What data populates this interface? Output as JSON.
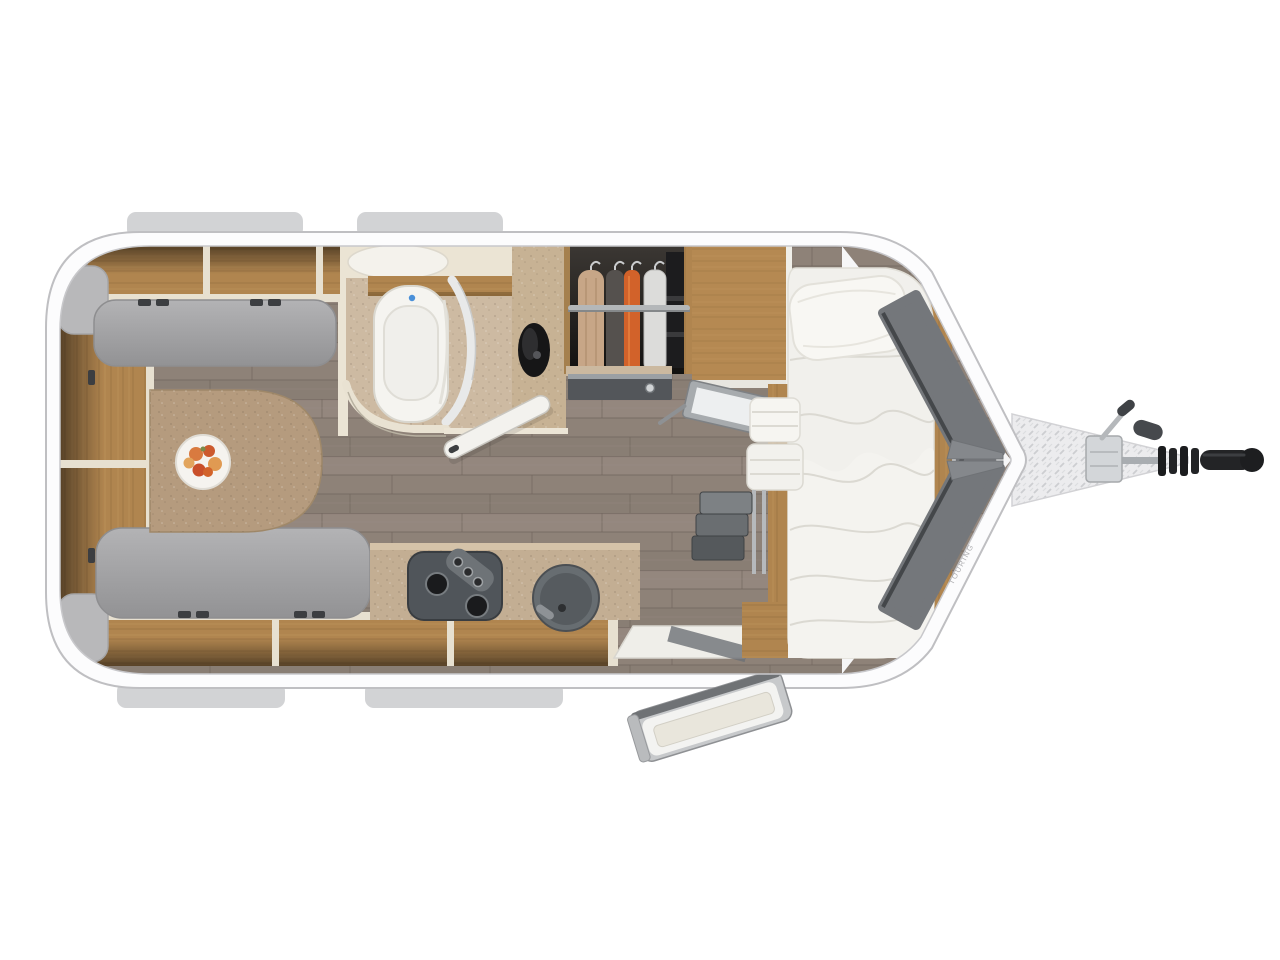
{
  "scene": {
    "description": "Top-down 3D rendered floor plan of a single-axle travel caravan with rear dinette, mid bathroom and wardrobe, kitchen block, fixed single bed and A-frame hitch",
    "brand_text": "TOURING",
    "colors": {
      "background": "#ffffff",
      "shell": "#fcfcfd",
      "shell_outline": "#bfbfc2",
      "rail_tab": "#d2d3d5",
      "floor": "#8e8278",
      "oak": "#b0854f",
      "cushion_light": "#b3b3b5",
      "cushion_dark": "#929294",
      "table": "#b59b7e",
      "counter": "#c3ae93",
      "mattress": "#f1f0ec",
      "bathroom_floor": "#cdbaa2",
      "cream_wall": "#e9e2d2",
      "panel_dark": "#74777b",
      "appliance_gray": "#50555a",
      "hitch_black": "#1e1f21",
      "garment_tan": "#c7a687",
      "garment_gray": "#55514e",
      "garment_orange": "#d2622a",
      "garment_white": "#dcdcda"
    },
    "areas": [
      "rear-dinette",
      "bathroom",
      "wardrobe",
      "overhead-cabinet",
      "kitchen",
      "fixed-bed",
      "entry-step",
      "entry-door",
      "a-frame-hitch"
    ]
  }
}
